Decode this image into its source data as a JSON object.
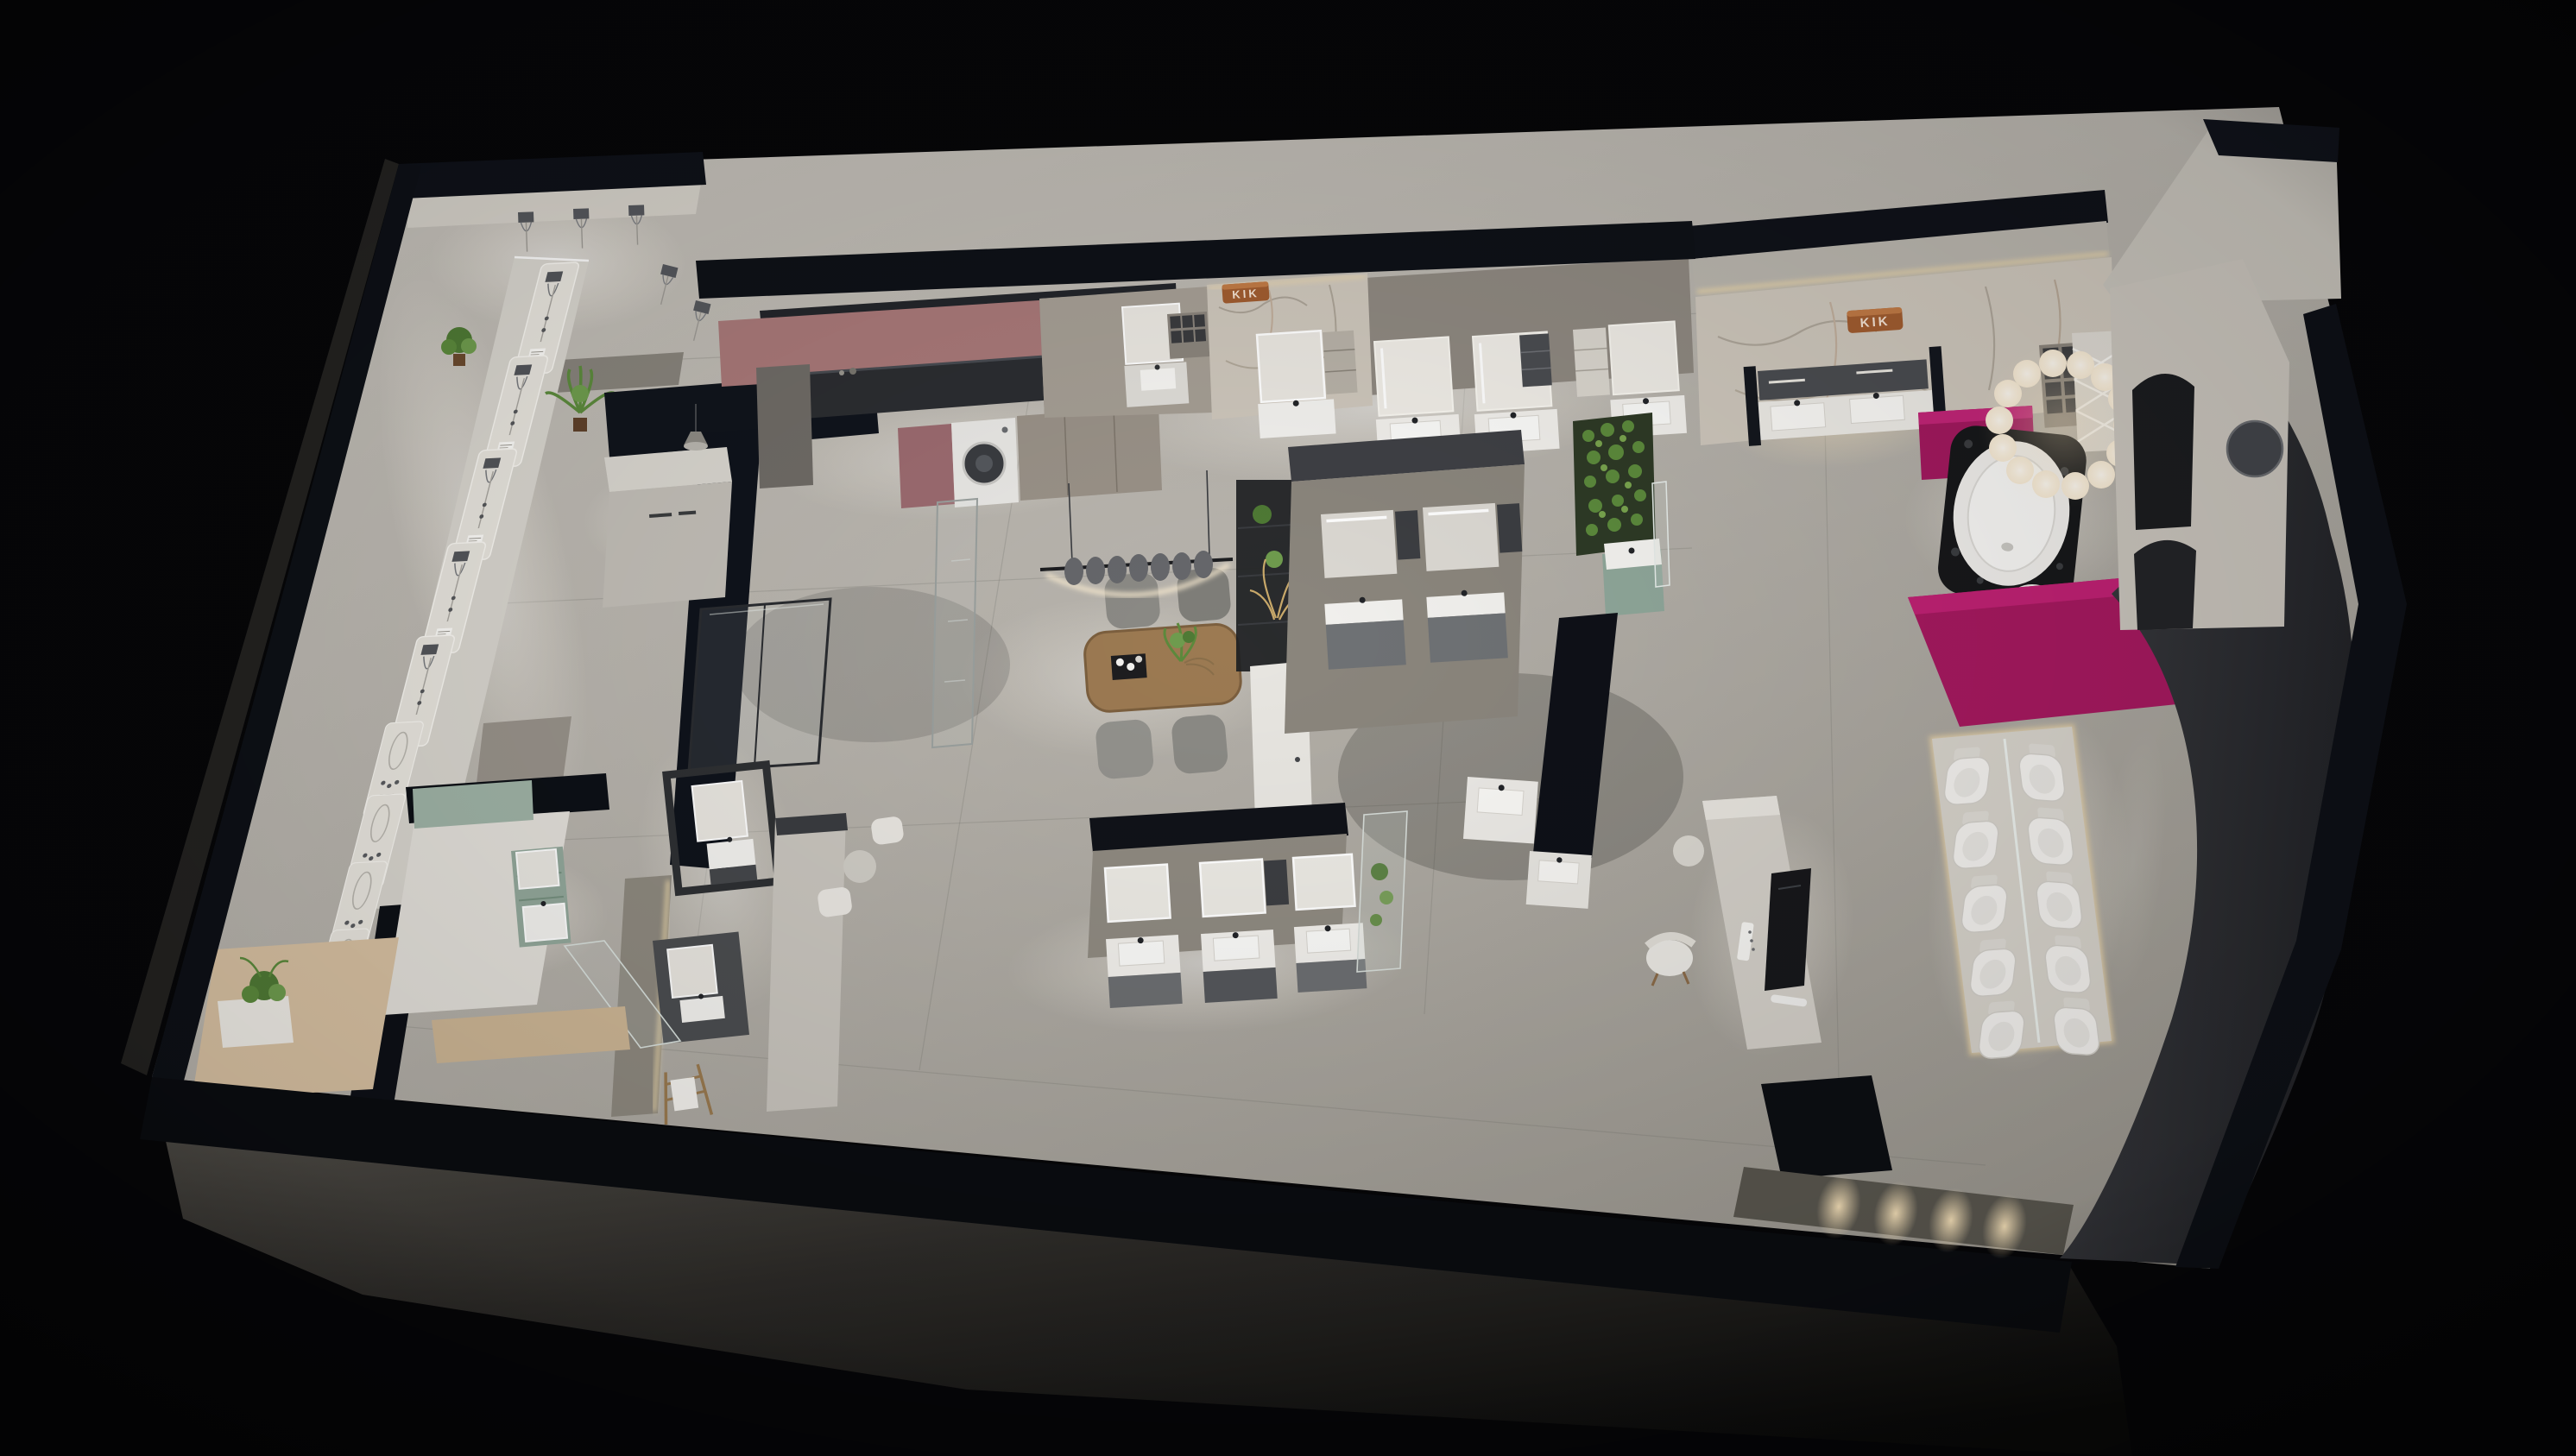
{
  "scene": {
    "kind": "3d-isometric-showroom-render",
    "subject": "bathroom sanitary-ware showroom floor plan, night view on black background",
    "view": "bird's-eye cutaway (walls sliced, tops shown dark navy)"
  },
  "signs": {
    "left_wall": "KIK",
    "right_wall": "KIK"
  },
  "palette": {
    "background": "#060608",
    "wall_top_navy": "#0e1118",
    "wall_charcoal": "#323338",
    "wall_face_light": "#c9c4bb",
    "wall_taupe": "#8e8880",
    "floor_light": "#d9d5ce",
    "floor_mid": "#b4b0a9",
    "floor_shadow": "#7e7b75",
    "facade_shadow": "#4e4b46",
    "accent_magenta": "#a5195f",
    "accent_dusty_pink": "#a87878",
    "accent_mint": "#93a89b",
    "marble": "#cdc6bb",
    "copper": "#a05c30",
    "wood": "#9c7a52",
    "plant_green": "#5c8a3c",
    "led_warm": "#f2dcae",
    "fixture_white": "#f1efec",
    "glass": "#cfd8d4"
  },
  "areas": [
    {
      "id": "corner-shower-room",
      "label": "corner shower display room"
    },
    {
      "id": "shower-display-wall",
      "label": "west shower-fittings display wall"
    },
    {
      "id": "reception-desk",
      "label": "reception desk with navy L partition"
    },
    {
      "id": "laundry-kitchen",
      "label": "laundry / kitchen display with washing machine"
    },
    {
      "id": "north-vanity-gallery",
      "label": "north vanity gallery with marble KIK wall"
    },
    {
      "id": "dining-area",
      "label": "consultation dining table with linear pendant"
    },
    {
      "id": "center-island",
      "label": "freestanding double vanity island"
    },
    {
      "id": "right-feature-zone",
      "label": "KIK marble wall, green wall, double vanity"
    },
    {
      "id": "bathtub-lounge",
      "label": "freestanding bathtub with ring chandelier and magenta desks"
    },
    {
      "id": "arch-wall",
      "label": "arched gallery wall with curved charcoal enclosure"
    },
    {
      "id": "toilet-display",
      "label": "back-to-back toilet display plinth"
    },
    {
      "id": "media-wall",
      "label": "TV media display counter"
    },
    {
      "id": "south-vanity-gallery",
      "label": "south vanity gallery"
    },
    {
      "id": "mint-ensuite",
      "label": "mint-green ensuite vanity display"
    },
    {
      "id": "decor-nook",
      "label": "warm decor nook with bench and plant"
    }
  ],
  "fixtures": {
    "shower_display_columns": 9,
    "corner_shower_heads": 6,
    "washing_machine": 1,
    "north_vanity_stations": 5,
    "island_vanities": 2,
    "right_double_vanity_basins": 2,
    "south_vanity_bays": 3,
    "standalone_vanities": 4,
    "toilets_on_plinth": 10,
    "freestanding_bathtub": 1,
    "dining_chairs": 4,
    "pendant_shades": 7,
    "ring_chandelier_spheres": 14,
    "front_wall_wash_lights": 4,
    "plants": 7,
    "towel_ladder": 1,
    "tv_display": 1
  }
}
